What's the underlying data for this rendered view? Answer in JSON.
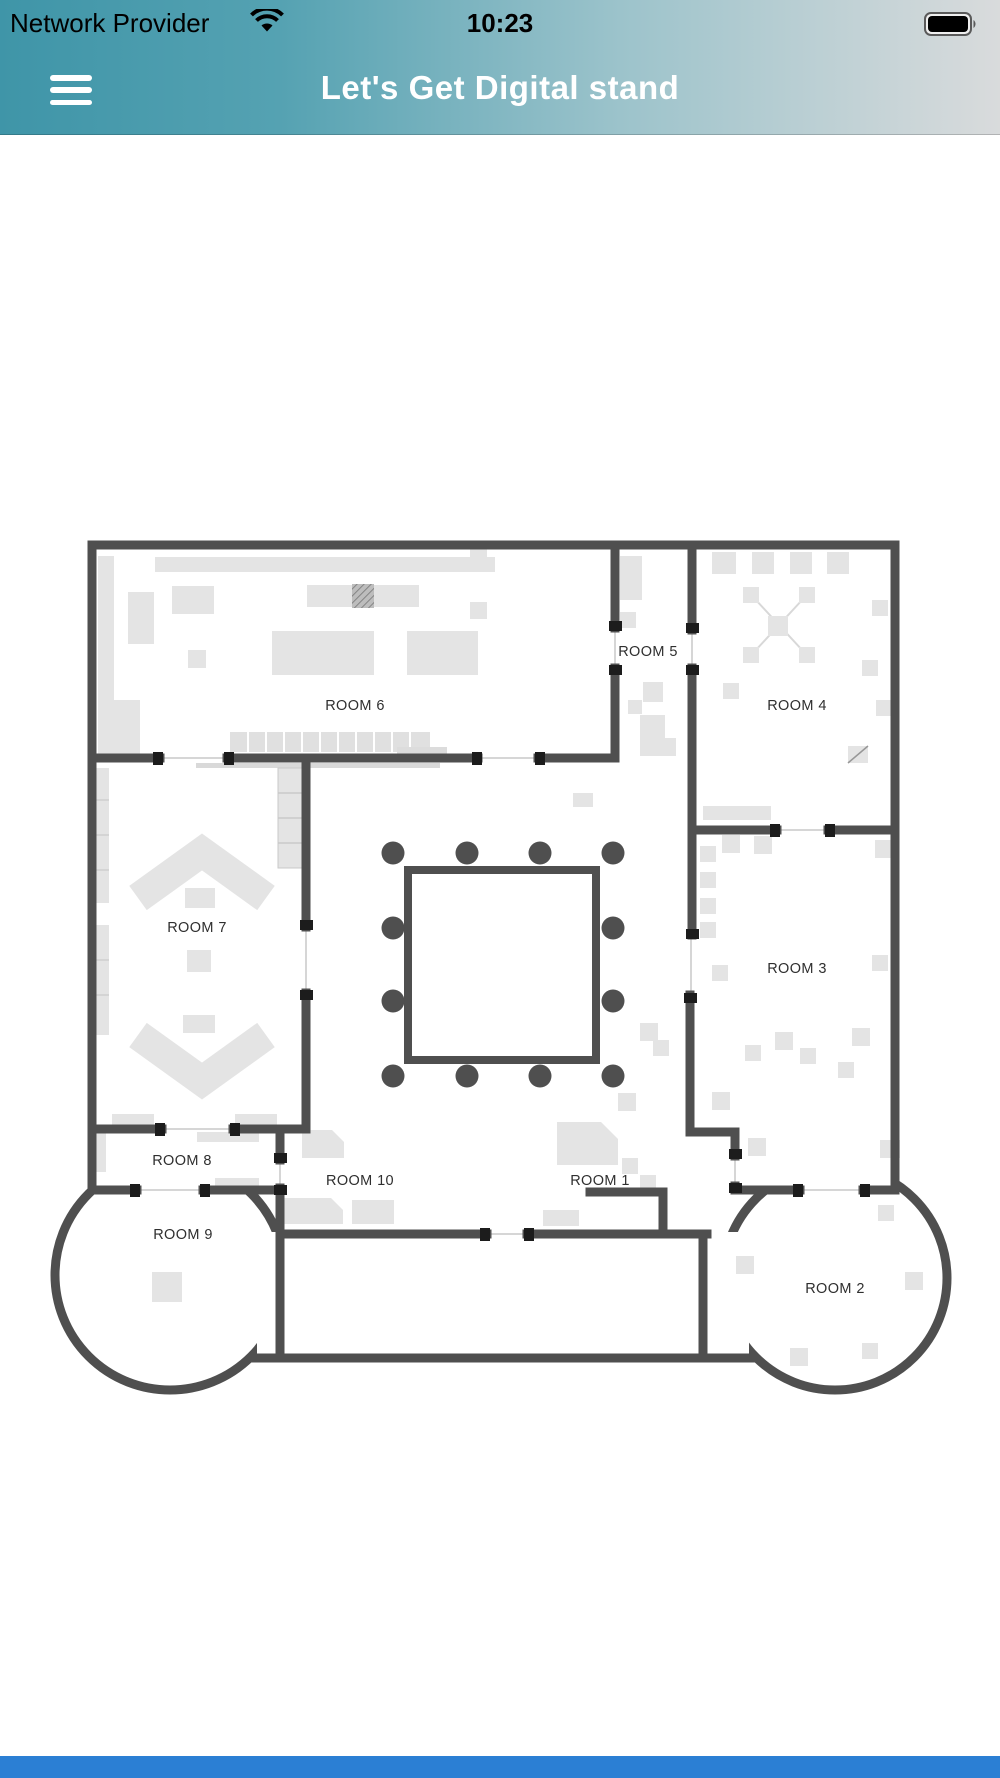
{
  "status_bar": {
    "carrier": "Network Provider",
    "time": "10:23",
    "wifi_icon": "wifi-icon",
    "battery_icon": "battery-icon",
    "battery_level": "full"
  },
  "header": {
    "title": "Let's Get Digital stand",
    "menu_icon": "hamburger-menu-icon"
  },
  "floor_plan": {
    "type": "venue-floor-map",
    "rooms": [
      {
        "id": "room-1",
        "label": "ROOM 1"
      },
      {
        "id": "room-2",
        "label": "ROOM 2"
      },
      {
        "id": "room-3",
        "label": "ROOM 3"
      },
      {
        "id": "room-4",
        "label": "ROOM 4"
      },
      {
        "id": "room-5",
        "label": "ROOM 5"
      },
      {
        "id": "room-6",
        "label": "ROOM 6"
      },
      {
        "id": "room-7",
        "label": "ROOM 7"
      },
      {
        "id": "room-8",
        "label": "ROOM 8"
      },
      {
        "id": "room-9",
        "label": "ROOM 9"
      },
      {
        "id": "room-10",
        "label": "ROOM 10"
      }
    ],
    "central_table_seats": 12,
    "highlighted_stand": "hatched stand in ROOM 6",
    "colors": {
      "wall": "#4f4f4f",
      "furniture": "#e4e4e4",
      "door_cap": "#1c1c1c",
      "header_teal": "#3f95a8",
      "footer_blue": "#2b7fd4"
    }
  }
}
